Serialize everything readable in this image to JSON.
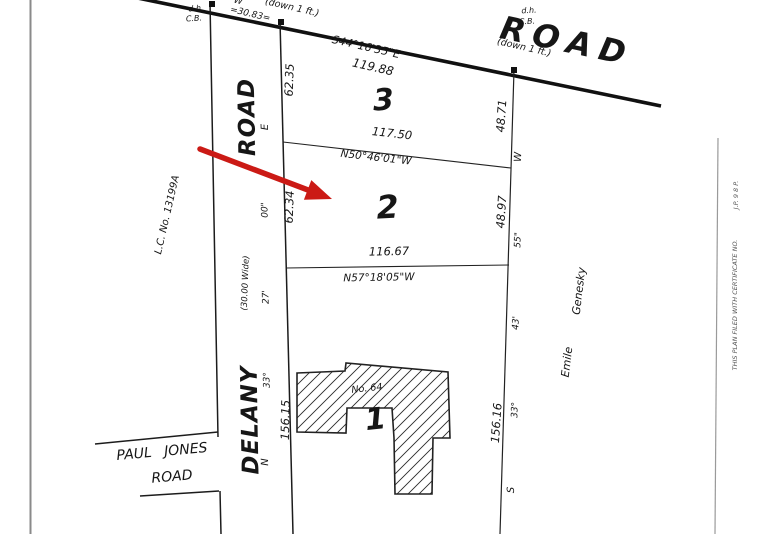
{
  "top_road": {
    "name": "ROAD",
    "bearing": "S44°16'35\"E",
    "distance": "119.88",
    "monument_left": {
      "dh": "d.h.",
      "cb": "C.B."
    },
    "monument_right": {
      "dh": "d.h.",
      "cb": "C.B.",
      "note": "(down 1 ft.)"
    },
    "partial_bearing_w": "W",
    "partial_note": "(down 1 ft.)",
    "delany_crossing_distance": "=30.83="
  },
  "delany_road": {
    "name_upper": "ROAD",
    "name_lower": "DELANY",
    "width_note": "(30.00 Wide)",
    "bearing": {
      "dir1": "N",
      "deg": "33°",
      "min": "27'",
      "sec": "00\"",
      "dir2": "E"
    },
    "land_court_no": "L.C. No. 13199A"
  },
  "paul_jones_road": {
    "name_line1": "PAUL JONES",
    "name_line2": "ROAD"
  },
  "east_boundary": {
    "bearing": {
      "dir1": "S",
      "deg": "33°",
      "min": "43'",
      "sec": "55\"",
      "dir2": "W"
    },
    "neighbor_first": "Emile",
    "neighbor_last": "Genesky"
  },
  "lots": {
    "lot3": {
      "number": "3",
      "front": "62.35",
      "rear": "48.71",
      "south_dist": "117.50",
      "south_bearing": "N50°46'01\"W"
    },
    "lot2": {
      "number": "2",
      "front": "62.34",
      "rear": "48.97",
      "south_dist": "116.67",
      "south_bearing": "N57°18'05\"W"
    },
    "lot1": {
      "number": "1",
      "front": "156.15",
      "rear": "156.16",
      "house_no": "No. 64"
    }
  },
  "margin": {
    "note1": "THIS PLAN FILED WITH CERTIFICATE NO.",
    "note2": "J.P. 9 8 P."
  },
  "annotation": {
    "arrow_color": "#cb1a15"
  }
}
